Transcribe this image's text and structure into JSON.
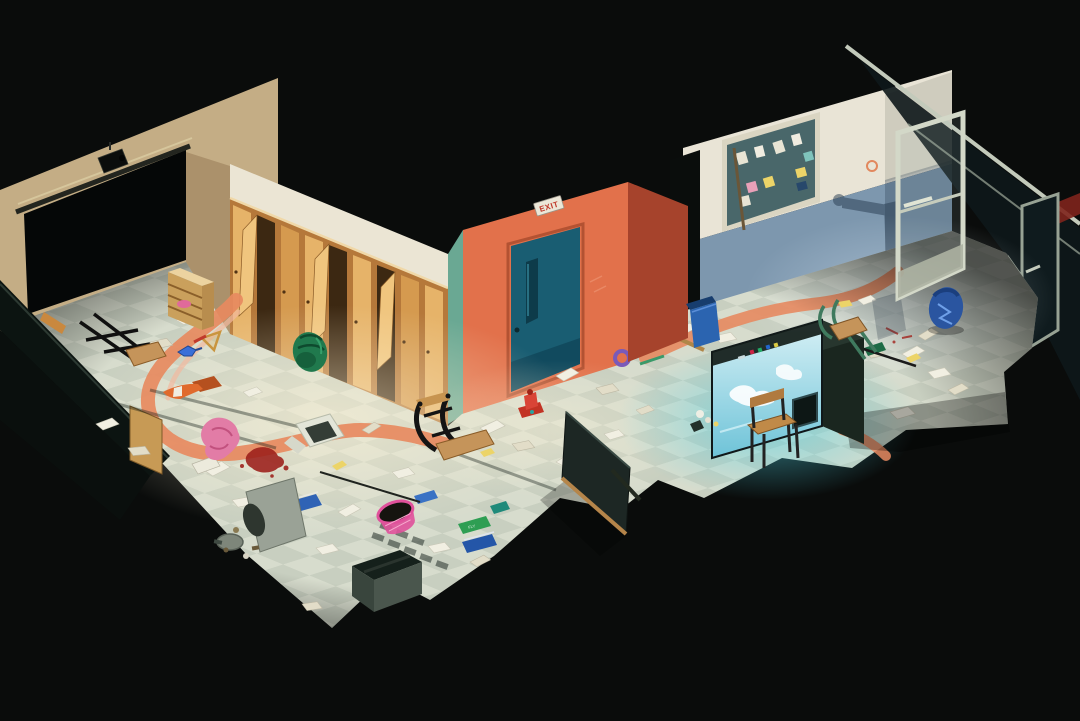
{
  "scene": {
    "description": "Isometric night-time cutaway illustration of a vandalized school: a storage room with a dark roll-up opening and security camera, a hallway with wooden lockers and an orange wall with a teal exit door, and a trashed classroom with a bulletin board, glowing aquarium and open aluminum glass door. Debris is scattered across a checkered tile floor on a black background.",
    "style": "isometric 3D illustration",
    "exit_sign": {
      "label": "EXIT"
    },
    "green_book_label": "FLY",
    "rooms": [
      {
        "name": "storage room",
        "features": [
          "large dark roll-up door opening",
          "security camera above opening",
          "wooden cubby shelf with pink cloth"
        ]
      },
      {
        "name": "hallway",
        "features": [
          "wooden lockers with doors ajar",
          "orange accent wall",
          "teal exit door with narrow window",
          "EXIT sign",
          "salmon wayfinding stripe painted on floor"
        ]
      },
      {
        "name": "classroom",
        "features": [
          "bulletin board with pinned notes",
          "blue wainscot wall with wall-mount shadow",
          "glowing aquarium with cloudy blue water",
          "open aluminum-framed glass door",
          "glass partition wall with second door ajar"
        ]
      }
    ],
    "debris": [
      "overturned hallway chair",
      "overturned classroom chair",
      "overturned stool",
      "upright wooden chair by aquarium",
      "fallen chalkboard",
      "toppled traffic cone",
      "tipped trash can spilling garbage",
      "pink mesh waste basket",
      "open white box",
      "open dark crate",
      "scattered papers",
      "yellow sticky notes",
      "scattered books",
      "green backpack by lockers",
      "blue backpack by glass door",
      "pink clothing",
      "blood stains",
      "blue toy water pistol",
      "wooden set square ruler",
      "red toy hydrant",
      "purple tape roll",
      "small action figure",
      "blue recycling bin"
    ]
  },
  "colors": {
    "background": "#0a0c0b",
    "wallBeige": "#c4ad85",
    "wallBeigeShade": "#ab916b",
    "wallCream": "#ebe5d4",
    "lockerWood": "#d59a4f",
    "lockerWoodLight": "#e6b369",
    "lockerFrame": "#b5783a",
    "lockerInterior": "#3c2812",
    "wallOrange": "#e2714b",
    "wallOrangeShade": "#a6432c",
    "wallTealReturn": "#6aa893",
    "doorTeal": "#195d72",
    "doorWindowTeal": "#0d3b4a",
    "classroomWhite": "#e9e4d6",
    "wainscotBlue": "#7d97ae",
    "bulletinBoard": "#49676a",
    "floorLight": "#d7dccd",
    "floorAlt": "#c8cfc0",
    "stripeSalmon": "#e78a60",
    "aquariumBody": "#27362e",
    "aquariumGlowTop": "#d8f1f6",
    "aquariumGlowBottom": "#6ec3d8",
    "glassFrame": "#c3cabb",
    "coneOrange": "#e06a2d",
    "clothPink": "#e27ca6",
    "bloodRed": "#9c1f1a",
    "basketPink": "#e0519b",
    "binBlue": "#2b64b0",
    "backpackGreen": "#20794d",
    "backpackBlue": "#2a55a0",
    "seatWood": "#c5945a",
    "exitSignBg": "#ece7d8",
    "exitSignText": "#c0392b"
  }
}
